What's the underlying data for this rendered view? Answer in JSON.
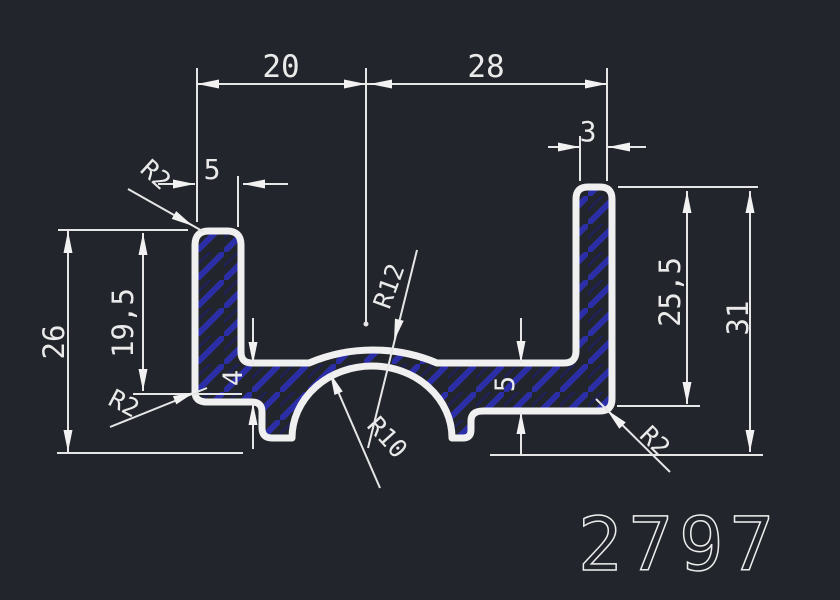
{
  "part_number": "2797",
  "dims": {
    "width_left": "20",
    "width_right": "28",
    "right_wall_thickness": "3",
    "left_wall_thickness": "5",
    "left_outer_height": "26",
    "left_inner_height": "19,5",
    "base_thickness_left": "4",
    "base_thickness_right": "5",
    "right_inner_height": "25,5",
    "right_outer_height": "31",
    "fillet_top_left": "R2",
    "fillet_bottom_left": "R2",
    "fillet_bottom_right": "R2",
    "arch_outer_radius": "R12",
    "arch_inner_radius": "R10"
  },
  "colors": {
    "background": "#22252b",
    "line_color": "#f0f0f0",
    "hatch_color": "#2c2ea8"
  }
}
